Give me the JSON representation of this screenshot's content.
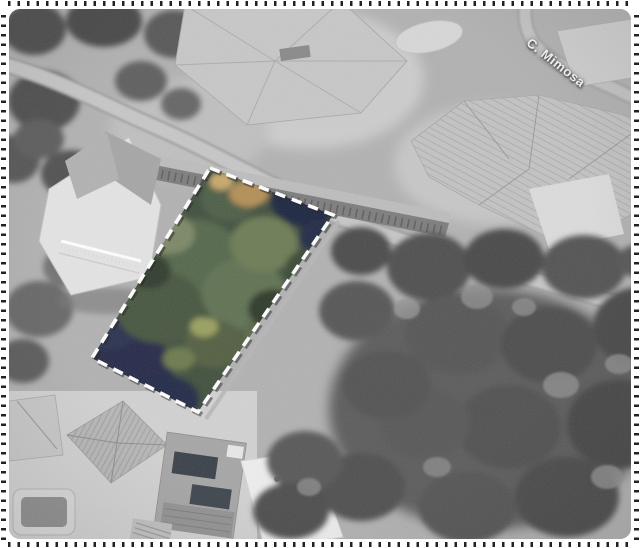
{
  "street_label": {
    "text": "C. Mimosa",
    "color": "#f2f2f2"
  },
  "frame": {
    "background": "#ffffff",
    "tick_color": "#222222",
    "corner_radius_px": 11
  },
  "parcel": {
    "points": "201,159 324,206 189,403 83,349",
    "outline_color": "#ffffff",
    "outline_style": "dashed",
    "outline_dash": "10.5 7",
    "outline_width": 3.6,
    "interior_palette": {
      "base_green": "#41503e",
      "mid_green": "#617252",
      "light_green": "#7c8866",
      "dark_green": "#2f3a2c",
      "shadow_navy": "#252b4a",
      "tan_tree": "#b38f57",
      "olive": "#8d8a54"
    }
  },
  "photo": {
    "tone": "grayscale",
    "base_gray": "#b2b2b2",
    "tree_gray": "#4e4e4e",
    "road_gray": "#c7c7c7",
    "roof_light": "#c8c8c8",
    "regions": [
      "main-road",
      "mimosa-road",
      "driveway-road",
      "terraced-wall-building",
      "villa-top-center",
      "swimming-pool-top",
      "villa-top-right",
      "villa-left",
      "houses-bottom-left",
      "solar-panel-roof",
      "swimming-pool-bottom-left",
      "tree-canopy-right",
      "trees-top-left",
      "highlighted-parcel"
    ]
  }
}
